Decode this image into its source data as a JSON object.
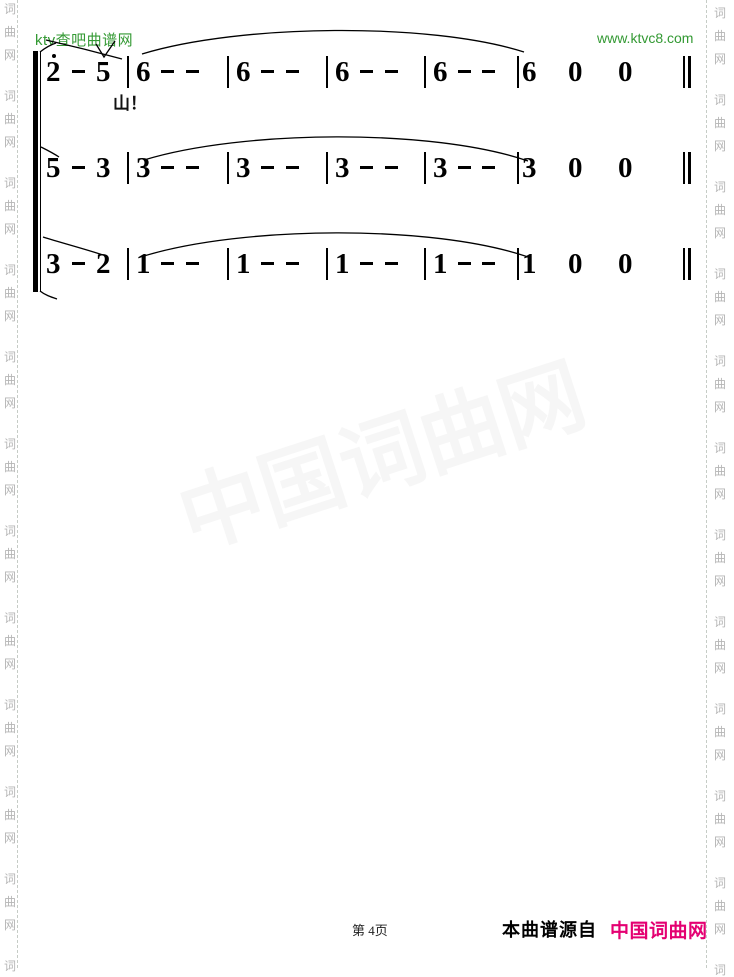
{
  "header": {
    "site_name": "ktv查吧曲谱网",
    "site_url": "www.ktvc8.com"
  },
  "colors": {
    "green": "#339933",
    "brand_pink": "#e40072",
    "watermark_gray": "#b5b5b5"
  },
  "watermark": {
    "chars": [
      "词",
      "曲",
      "网"
    ],
    "center_text": "中国词曲网"
  },
  "score": {
    "lines": [
      {
        "tokens": [
          "2",
          "-",
          "5",
          "|",
          "6",
          "-",
          "-",
          "|",
          "6",
          "-",
          "-",
          "|",
          "6",
          "-",
          "-",
          "|",
          "6",
          "-",
          "-",
          "|",
          "6",
          "0",
          "0",
          "||"
        ],
        "octave_dot_index": 0,
        "lyric": "山！"
      },
      {
        "tokens": [
          "5",
          "-",
          "3",
          "|",
          "3",
          "-",
          "-",
          "|",
          "3",
          "-",
          "-",
          "|",
          "3",
          "-",
          "-",
          "|",
          "3",
          "-",
          "-",
          "|",
          "3",
          "0",
          "0",
          "||"
        ]
      },
      {
        "tokens": [
          "3",
          "-",
          "2",
          "|",
          "1",
          "-",
          "-",
          "|",
          "1",
          "-",
          "-",
          "|",
          "1",
          "-",
          "-",
          "|",
          "1",
          "-",
          "-",
          "|",
          "1",
          "0",
          "0",
          "||"
        ]
      }
    ]
  },
  "footer": {
    "page_label": "第 4页",
    "source_label": "本曲谱源自",
    "brand_name": "中国词曲网"
  }
}
